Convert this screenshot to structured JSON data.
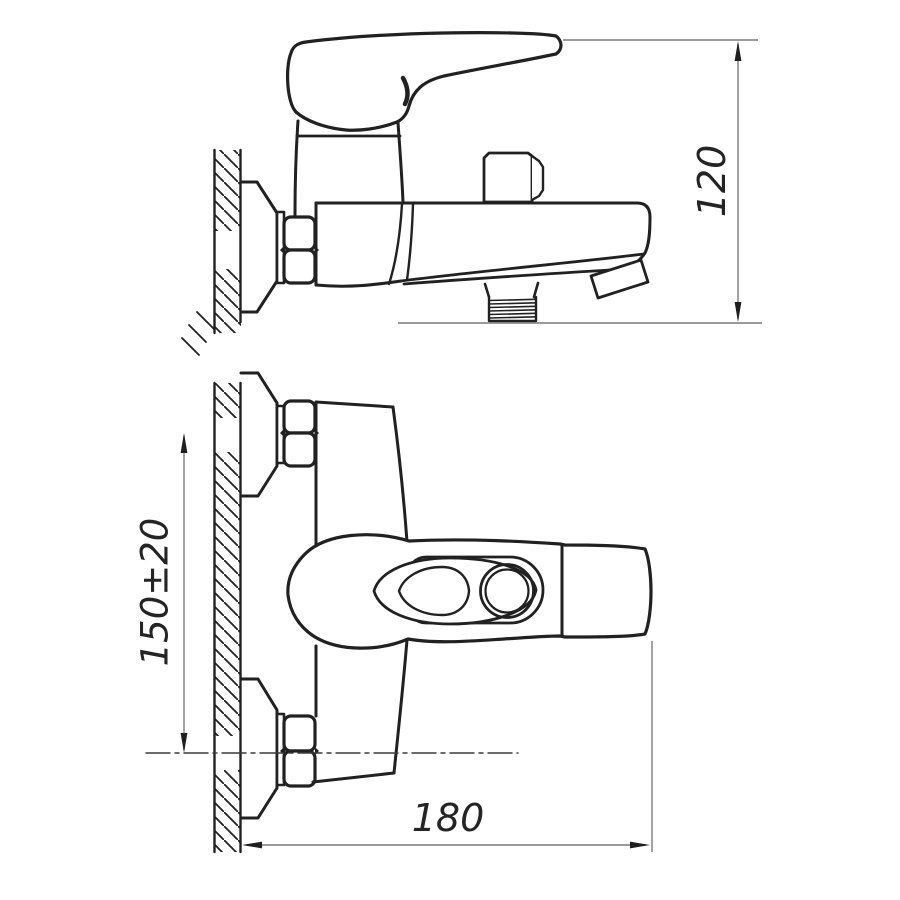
{
  "dims": {
    "height": "120",
    "spacing": "150±20",
    "length": "180"
  },
  "colors": {
    "line": "#212121",
    "dim_line": "#7a7a7a",
    "arrow": "#1f1f1f",
    "text": "#242424",
    "background": "#ffffff"
  }
}
